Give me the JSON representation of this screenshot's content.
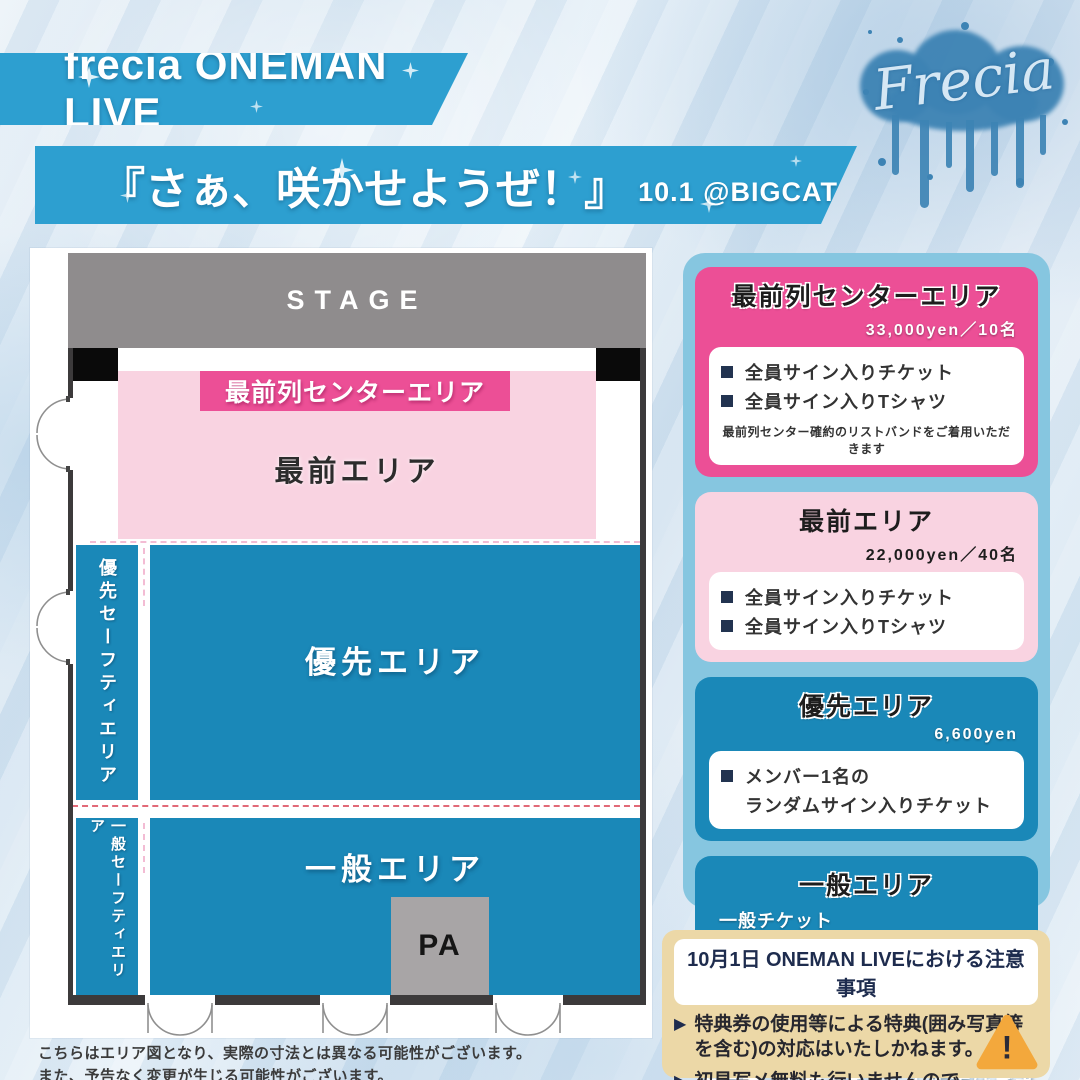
{
  "header": {
    "event_title": "frecia ONEMAN LIVE",
    "show_title": "『さぁ、咲かせようぜ！』",
    "date_venue": "10.1 @BIGCAT",
    "logo_text": "Frecia"
  },
  "map": {
    "stage": "STAGE",
    "front_center_banner": "最前列センターエリア",
    "front_area": "最前エリア",
    "priority_safety": "優先セーフティエリア",
    "general_safety": "一般セーフティエリア",
    "priority_area": "優先エリア",
    "general_area": "一般エリア",
    "pa": "PA"
  },
  "pricing_cards": [
    {
      "title": "最前列センターエリア",
      "price": "33,000yen／10名",
      "items": [
        "全員サイン入りチケット",
        "全員サイン入りTシャツ"
      ],
      "note": "最前列センター確約のリストバンドをご着用いただきます"
    },
    {
      "title": "最前エリア",
      "price": "22,000yen／40名",
      "items": [
        "全員サイン入りチケット",
        "全員サイン入りTシャツ"
      ]
    },
    {
      "title": "優先エリア",
      "price": "6,600yen",
      "item_line1": "メンバー1名の",
      "item_line2": "ランダムサイン入りチケット"
    },
    {
      "title": "一般エリア",
      "body_line1": "一般チケット",
      "body_line2": "招待チケット（手売りのみ）",
      "price": "各1,000yen"
    }
  ],
  "ticket_sales": {
    "line1": "TIGETにてチケット発売",
    "line2": "クラファンでのチケット販売はございません"
  },
  "notice": {
    "header": "10月1日 ONEMAN LIVEにおける注意事項",
    "items": [
      {
        "l1": "特典券の使用等による特典(囲み写真等",
        "l2": "を含む)の対応はいたしかねます。"
      },
      {
        "l1": "初見写メ無料も行いませんので",
        "l2": "ご了承ください。"
      }
    ],
    "warning_mark": "!"
  },
  "footer": {
    "line1": "こちらはエリア図となり、実際の寸法とは異なる可能性がございます。",
    "line2": "また、予告なく変更が生じる可能性がございます。"
  },
  "colors": {
    "banner_blue": "#2d9fd0",
    "map_blue": "#1a88b8",
    "hot_pink": "#ec4f96",
    "light_pink": "#f9d3e1",
    "panel_blue": "#86c6e0",
    "stage_gray": "#8f8c8d",
    "pa_gray": "#a8a5a6",
    "notice_beige": "#ecd8a7",
    "warning_orange": "#f3a83c"
  }
}
